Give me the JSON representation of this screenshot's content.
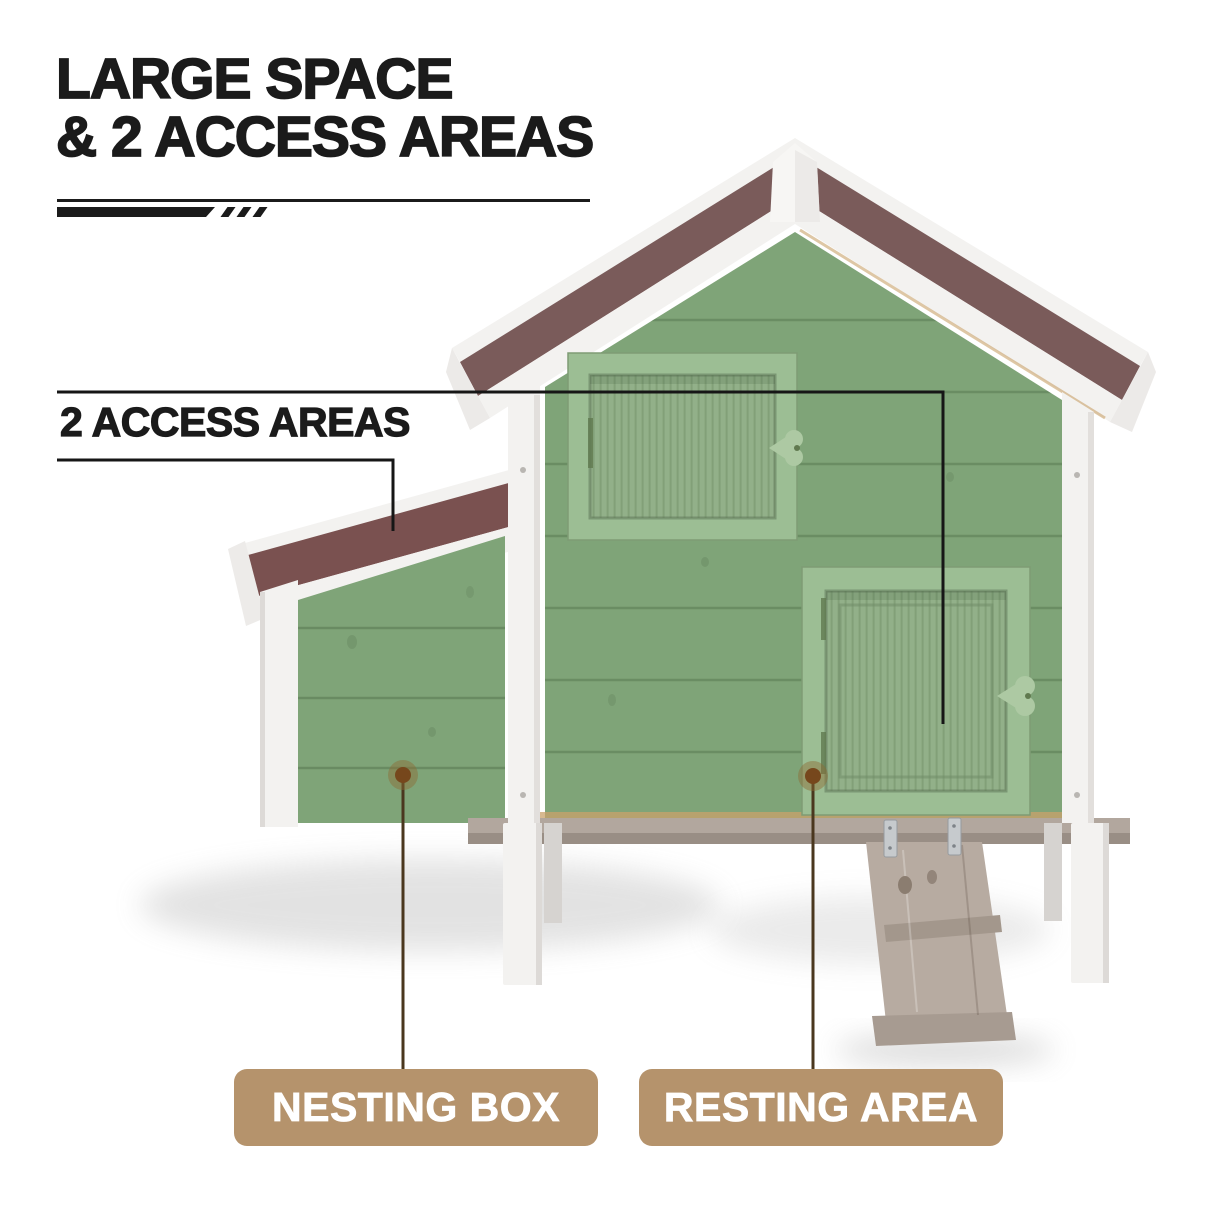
{
  "title": {
    "line1": "LARGE SPACE",
    "line2": "& 2 ACCESS AREAS"
  },
  "callout": {
    "label": "2 ACCESS AREAS"
  },
  "feature_labels": {
    "nesting_box": "NESTING BOX",
    "resting_area": "RESTING AREA"
  },
  "illustration": {
    "description": "Wooden chicken coop with green plank walls, white trim and legs, brown shingle gable roof, upper access window with heart latch, lower resting-area door with ramp, and a side nesting box annex with sloped roof"
  },
  "colors": {
    "label_bg": "#B5936C",
    "label_text": "#FFFFFF",
    "ink": "#1B1B1B",
    "callout_line": "#161616",
    "leader_line": "#4A371E",
    "dot_brown": "#76471C",
    "wall_green": "#7FA478",
    "frame_green": "#9CBE94",
    "slat_green": "#92B089",
    "roof_brown": "#7A5B5A",
    "annex_roof_brown": "#7A5150",
    "trim_white": "#F3F2F0",
    "floor_gray": "#B2A79E",
    "ramp_gray": "#B7ABA1",
    "tan_edge": "#C9A26B"
  }
}
